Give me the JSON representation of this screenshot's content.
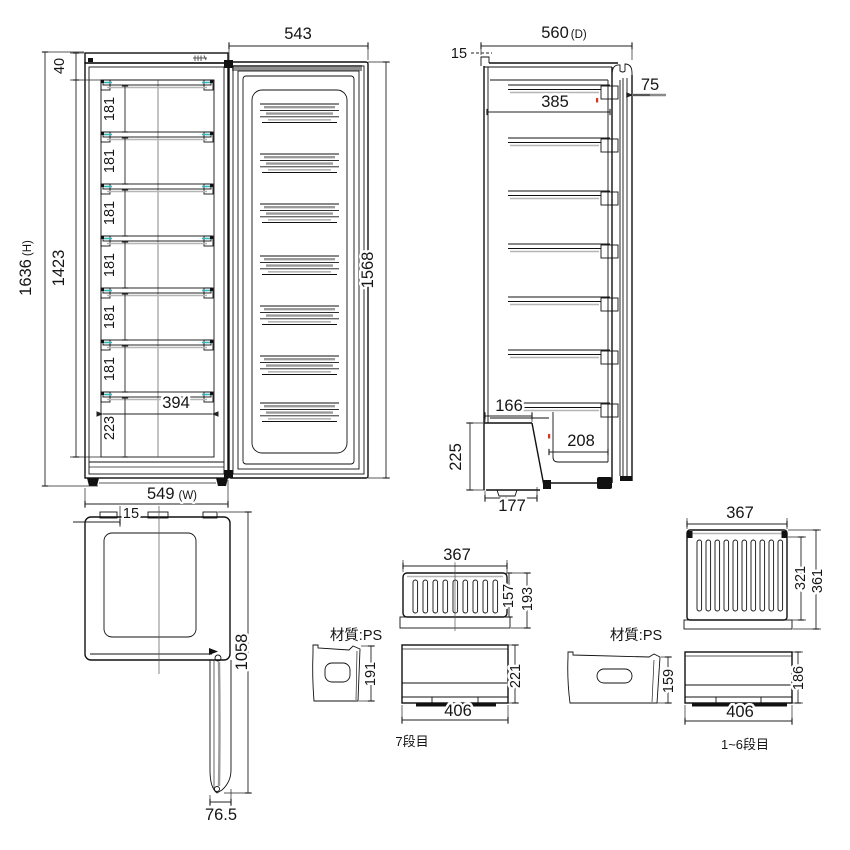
{
  "front_view": {
    "door_width": "543",
    "top_clearance": "40",
    "overall_height": {
      "value": "1636",
      "suffix": "(H)"
    },
    "interior_height": "1423",
    "shelf_pitches": [
      "181",
      "181",
      "181",
      "181",
      "181",
      "181"
    ],
    "bottom_drawer_height": "223",
    "bottom_inner_width": "394",
    "overall_width": {
      "value": "549",
      "suffix": "(W)"
    },
    "door_height": "1568"
  },
  "side_view": {
    "overall_depth": {
      "value": "560",
      "suffix": "(D)"
    },
    "rear_clearance": "15",
    "door_front_offset": "75",
    "shelf_depth": "385",
    "machine_room_width": "166",
    "machine_room_height": "225",
    "machine_room_depth": "208",
    "base_width": "177"
  },
  "top_view": {
    "hinge_offset": "15",
    "door_open_depth": "1058",
    "door_open_width": "76.5"
  },
  "drawer_detail_7th": {
    "material_label": "材質:PS",
    "caption": "7段目",
    "width_top": "367",
    "depth_inner": "157",
    "depth_outer": "193",
    "side_height": "191",
    "front_height": "221",
    "front_width": "406"
  },
  "drawer_detail_1_6": {
    "material_label": "材質:PS",
    "caption": "1~6段目",
    "width_top": "367",
    "depth_inner": "321",
    "depth_outer": "361",
    "side_height": "159",
    "front_height": "186",
    "front_width": "406"
  },
  "colors": {
    "line": "#111111",
    "dim": "#222222",
    "shade_gray": "#9a9a9a",
    "accent_cyan": "#35b8b8",
    "accent_red": "#dd3322",
    "background": "#ffffff"
  }
}
